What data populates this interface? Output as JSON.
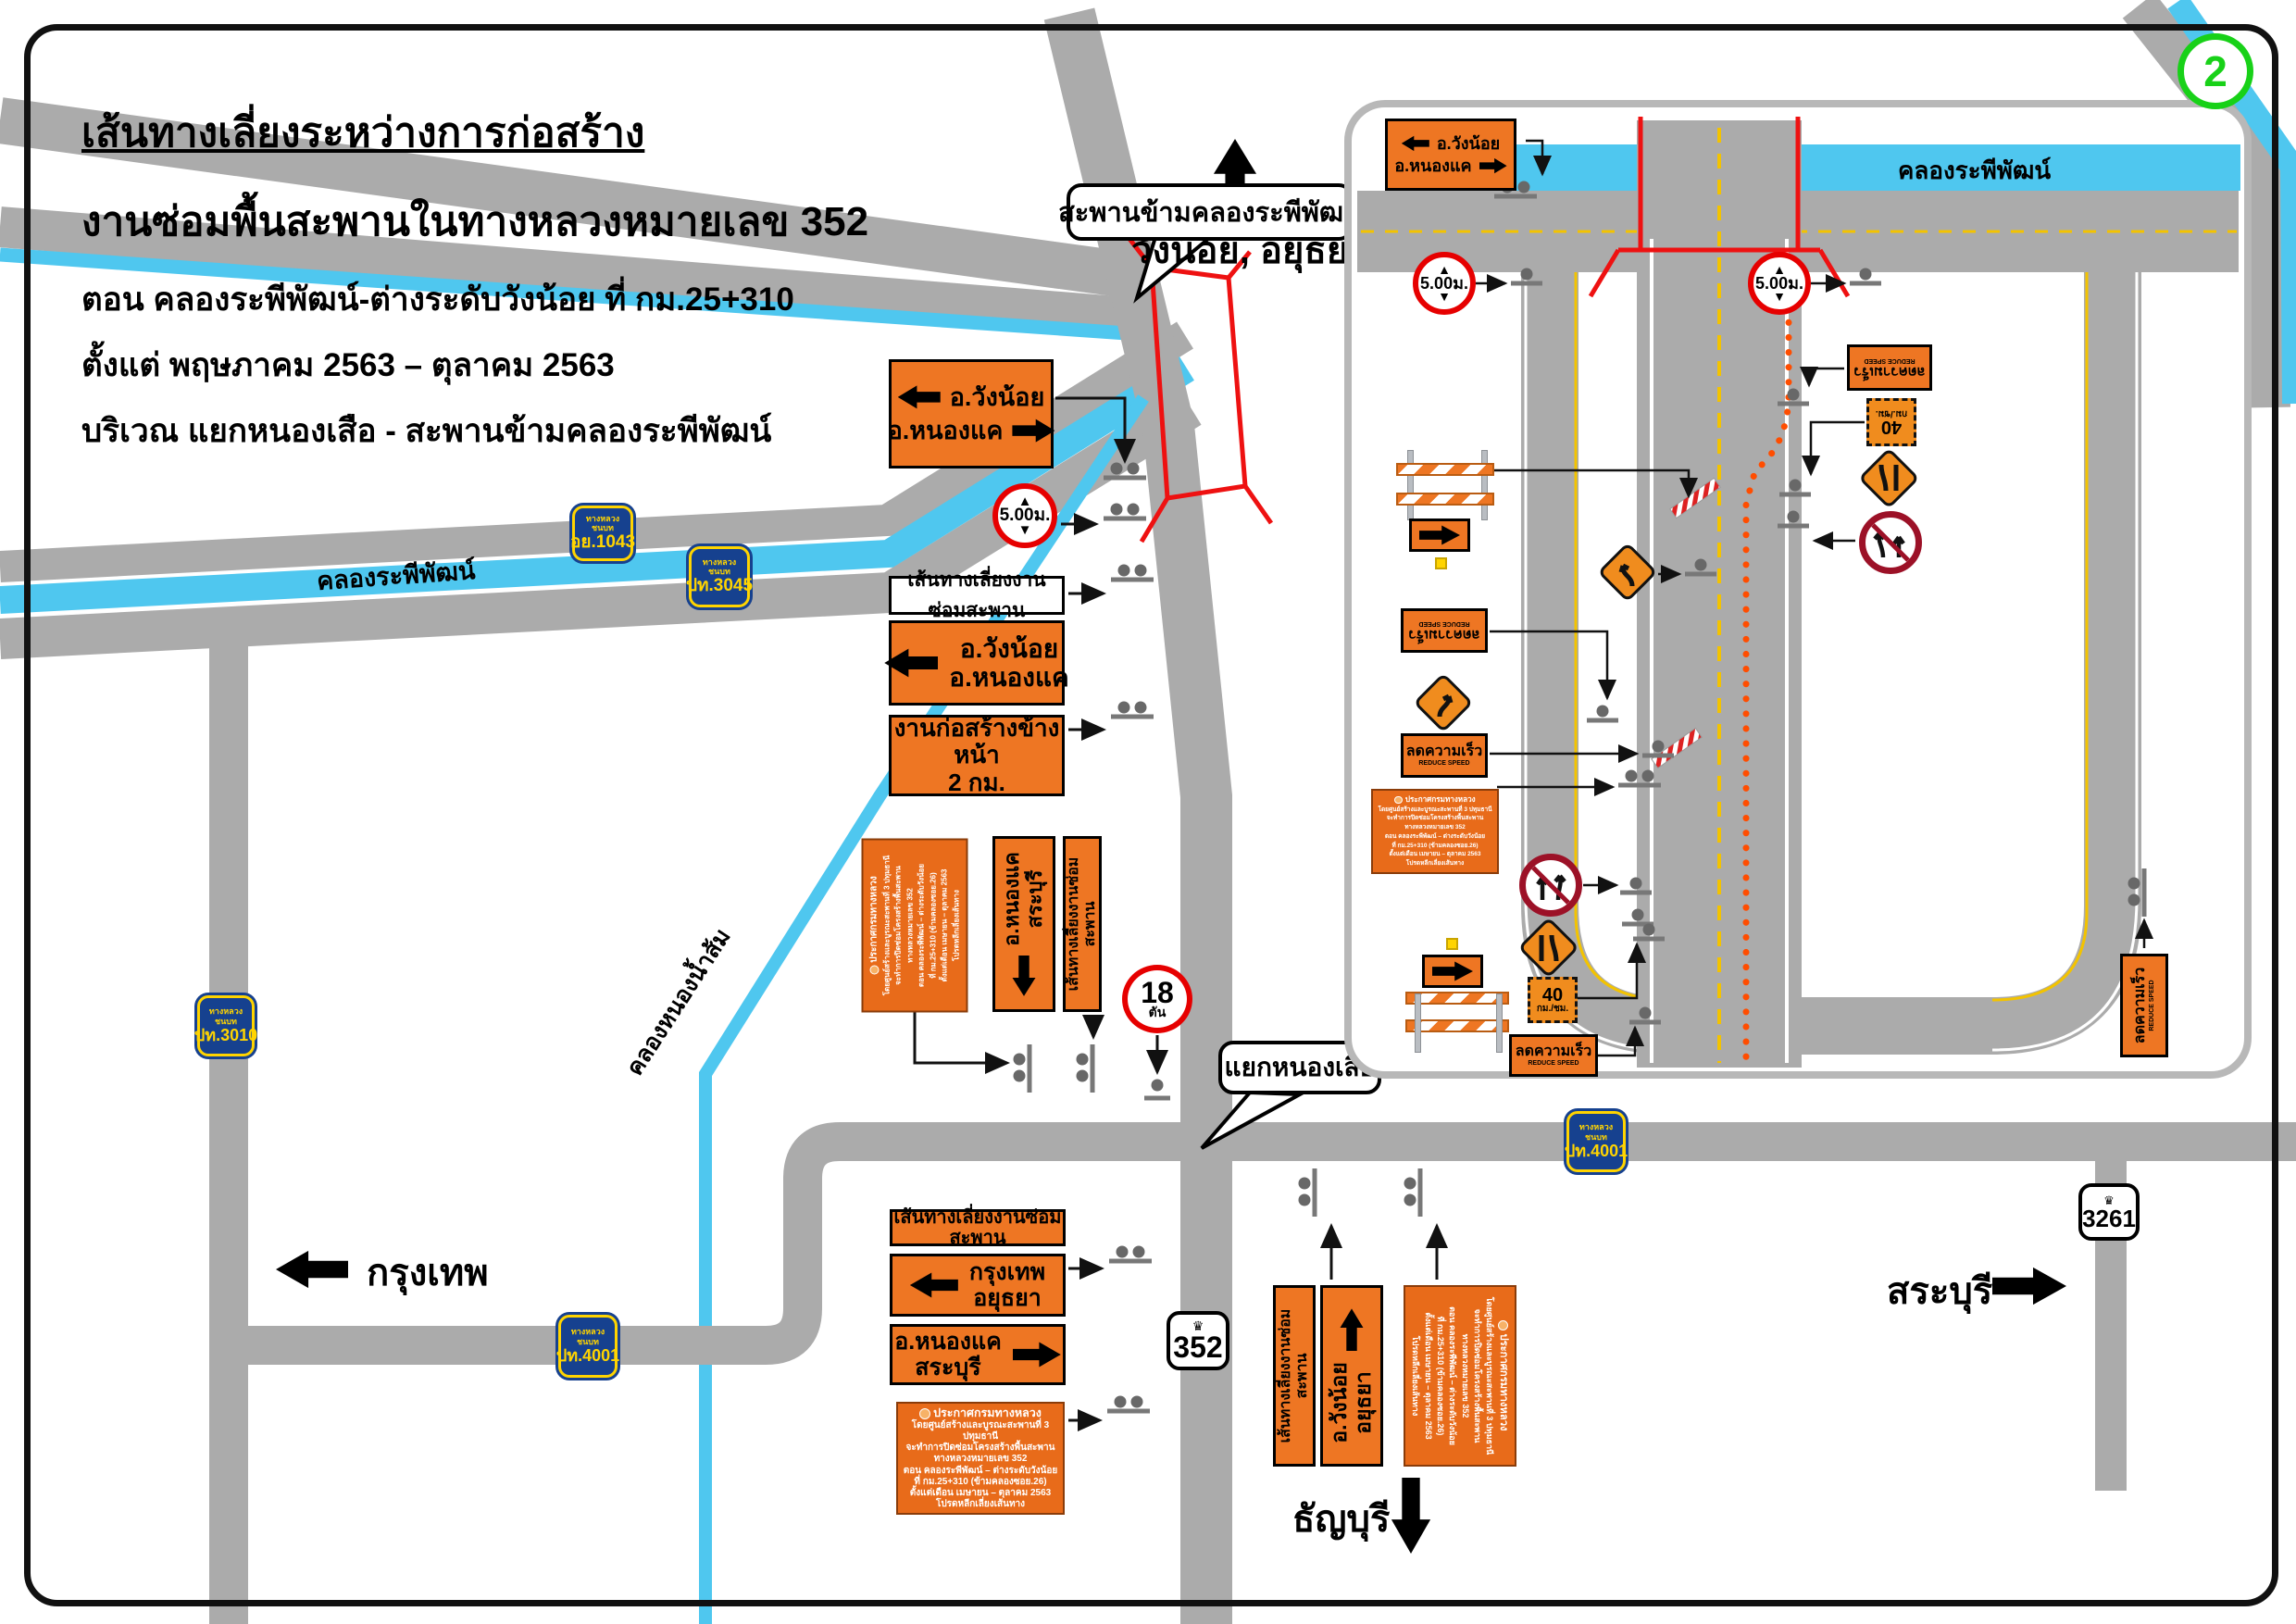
{
  "page": {
    "badge": "2"
  },
  "title": {
    "l1": "เส้นทางเลี่ยงระหว่างการก่อสร้าง",
    "l2": "งานซ่อมพื้นสะพานในทางหลวงหมายเลข 352",
    "l3": "ตอน คลองระพีพัฒน์-ต่างระดับวังน้อย ที่ กม.25+310",
    "l4": "ตั้งแต่ พฤษภาคม 2563 – ตุลาคม 2563",
    "l5": "บริเวณ แยกหนองเสือ - สะพานข้ามคลองระพีพัฒน์"
  },
  "labels": {
    "north_dest": "วังน้อย, อยุธยา",
    "bangkok": "กรุงเทพ",
    "saraburi": "สระบุรี",
    "thanyaburi": "ธัญบุรี",
    "canal_rapiphat": "คลองระพีพัฒน์",
    "canal_nong_nam_som": "คลองหนองน้ำส้ม"
  },
  "callouts": {
    "bridge": "สะพานข้ามคลองระพีพัฒน์",
    "junction": "แยกหนองเสือ"
  },
  "badges": {
    "label": "ทางหลวงชนบท",
    "ay1043": "อย.1043",
    "pt3045": "ปท.3045",
    "pt3010": "ปท.3010",
    "pt4001": "ปท.4001"
  },
  "shields": {
    "s352": "352",
    "s3261": "3261"
  },
  "signs": {
    "detour": "เส้นทางเลี่ยงงานซ่อมสะพาน",
    "wangnoi": "อ.วังน้อย",
    "nongkhae": "อ.หนองแค",
    "ayutthaya": "อยุธยา",
    "saraburi": "สระบุรี",
    "bangkok": "กรุงเทพ",
    "construction1": "งานก่อสร้างข้างหน้า",
    "construction2": "2 กม.",
    "height": "5.00ม.",
    "w18": "18",
    "ton": "ตัน",
    "reduce_th": "ลดความเร็ว",
    "reduce_en": "REDUCE SPEED",
    "s40": "40",
    "kmh": "กม./ชม."
  },
  "announcement": {
    "l1": "ประกาศกรมทางหลวง",
    "l2": "โดยศูนย์สร้างและบูรณะสะพานที่ 3 ปทุมธานี",
    "l3": "จะทำการปิดซ่อมโครงสร้างพื้นสะพาน",
    "l4": "ทางหลวงหมายเลข 352",
    "l5": "ตอน คลองระพีพัฒน์ – ต่างระดับวังน้อย",
    "l6": "ที่ กม.25+310 (ข้ามคลองซอย.26)",
    "l7": "ตั้งแต่เดือน เมษายน – ตุลาคม 2563",
    "l8": "โปรดหลีกเลี่ยงเส้นทาง"
  },
  "colors": {
    "road": "#ababab",
    "canal": "#4fc7ef",
    "sign_orange": "#ee7623",
    "badge_blue": "#16418f",
    "badge_yellow": "#ffd400",
    "red": "#e60000",
    "cone_orange": "#ff4d00",
    "green": "#18d118"
  }
}
